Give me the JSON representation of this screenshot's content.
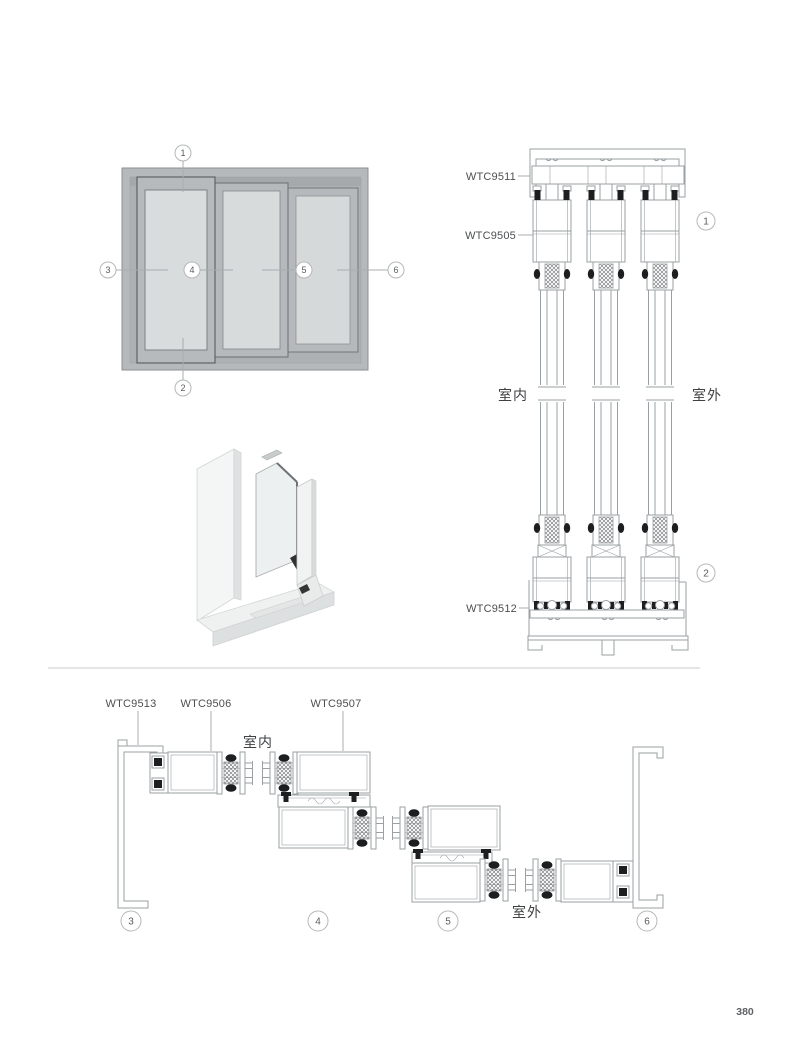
{
  "page": {
    "number": "380"
  },
  "colors": {
    "drawing_line": "#9aa0a3",
    "gasket_black": "#1d1e1f",
    "label_text": "#4d4f51",
    "frame_gray": "#b6b9bb",
    "recess_gray": "#aeb1b3",
    "glass_gray": "#d8dbdc",
    "callout_ring": "#b5b8ba",
    "divider": "#c9cbcc"
  },
  "elevation": {
    "callouts": {
      "c1": "1",
      "c2": "2",
      "c3": "3",
      "c4": "4",
      "c5": "5",
      "c6": "6"
    }
  },
  "vertical_section": {
    "label_top_frame": "WTC9511",
    "label_sash": "WTC9505",
    "label_bottom_frame": "WTC9512",
    "indoor": "室内",
    "outdoor": "室外",
    "callout_top": "1",
    "callout_bottom": "2"
  },
  "horizontal_section": {
    "label_side_frame": "WTC9513",
    "label_sash": "WTC9506",
    "label_sash2": "WTC9507",
    "indoor": "室内",
    "outdoor": "室外",
    "callout_left": "3",
    "callout_mid_left": "4",
    "callout_mid_right": "5",
    "callout_right": "6"
  }
}
